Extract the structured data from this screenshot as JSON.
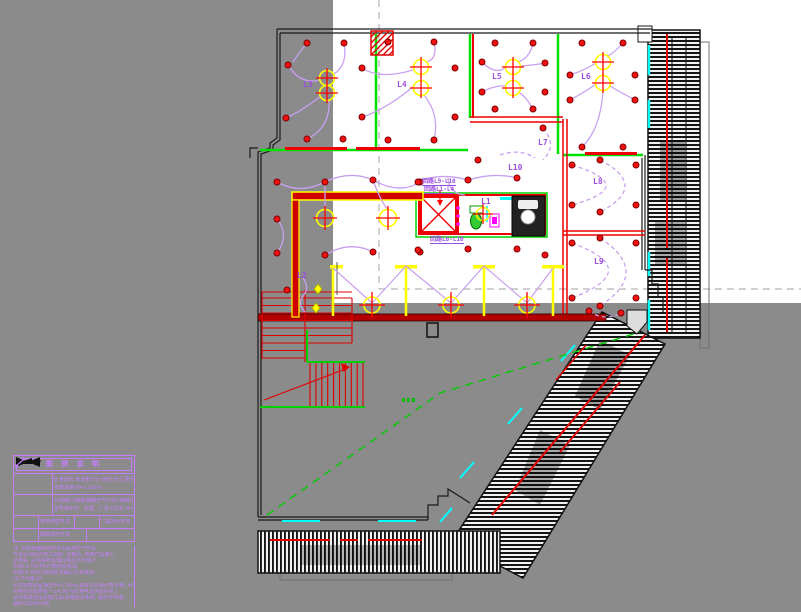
{
  "labels": {
    "l1": "L1",
    "l2": "L2",
    "l3": "L3",
    "l4": "L4",
    "l5": "L5",
    "l6": "L6",
    "l7": "L7",
    "l8": "L8",
    "l9": "L9",
    "l10": "L10"
  },
  "circuits": {
    "c1": "回路L9-L10",
    "c2": "回路L1-L4",
    "c3": "回路L8-L10"
  },
  "legend": {
    "title": "图 例 说 明",
    "row_a_line1": "B 金卤灯 轨道射灯(小射灯)为汇报厅照明",
    "row_a_line2": "安装高度(H=1.50m)",
    "row_b_line1": "分线箱(内装断路器空气开关)(暗装)距地1.4m",
    "row_b_line2": "型号由甲方、监理、广告公司定 H=1.40m",
    "row_c_cell1": "单极墙壁开关",
    "row_c_cell2": "二联防水开关",
    "row_d_cell1": "四联单控开关",
    "notes": [
      "注. 所有电器照明开关均采用空气开关.",
      "开关必须经过电工验收. 合格后, 启用灯具接入",
      "总电源. 必须得到监理同意后方可施工.",
      "所有L4.5线T形灯箱预留电源:",
      "所有L4.5线以现场补充确认开关电源:",
      "(以下为备注):",
      "吊顶标高预留净空H=1.50m(具体以现场计算为准, 吊顶",
      "内电线均需穿管一±4.8V为标准电源供给补给.)",
      "吊顶标高预留多套灯具(多路空调系统, 展示灯环境,",
      "最终以现场为准)"
    ]
  },
  "colors": {
    "background": "#8b8b8b",
    "paper": "#ffffff",
    "walls_green": "#00e000",
    "walls_red": "#ee0000",
    "wire_purple": "#c9a0f0",
    "label_purple": "#9b4fe0",
    "legend_magenta": "#c77dff",
    "fixture_yellow": "#ffff00",
    "cyan_accent": "#00ffff",
    "hatch_black": "#151515"
  }
}
